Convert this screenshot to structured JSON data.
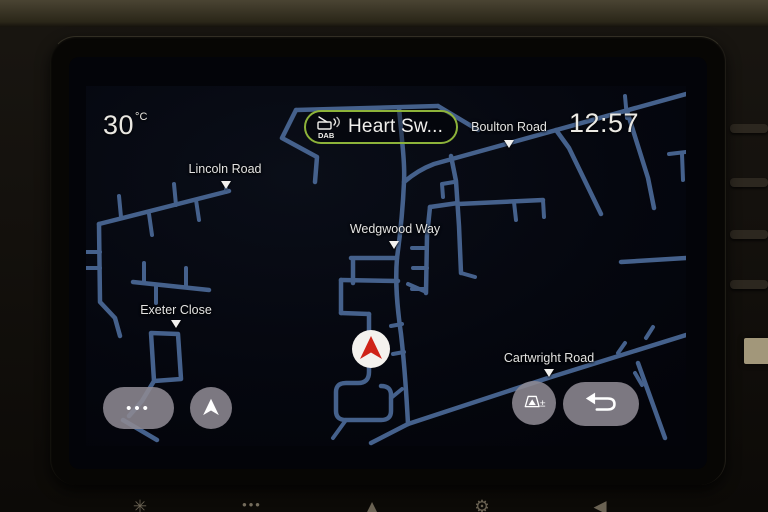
{
  "status_bar": {
    "temperature": "30",
    "temperature_unit": "°C",
    "clock": "12:57"
  },
  "radio_badge": {
    "source": "DAB",
    "station": "Heart Sw..."
  },
  "map": {
    "labels": [
      {
        "text": "Lincoln Road"
      },
      {
        "text": "Boulton Road"
      },
      {
        "text": "Wedgwood Way"
      },
      {
        "text": "Exeter Close"
      },
      {
        "text": "Cartwright Road"
      }
    ]
  },
  "buttons": {
    "more_dots": "•••",
    "zoom_auto_symbol": "±"
  },
  "bottom_bar": {
    "glyphs": [
      "✳",
      "•••",
      "▲",
      "⚙",
      "◀"
    ]
  },
  "colors": {
    "road": "#45618c",
    "badge_green": "#8db33a",
    "marker_red": "#cf2318",
    "map_background": "#05070f"
  }
}
